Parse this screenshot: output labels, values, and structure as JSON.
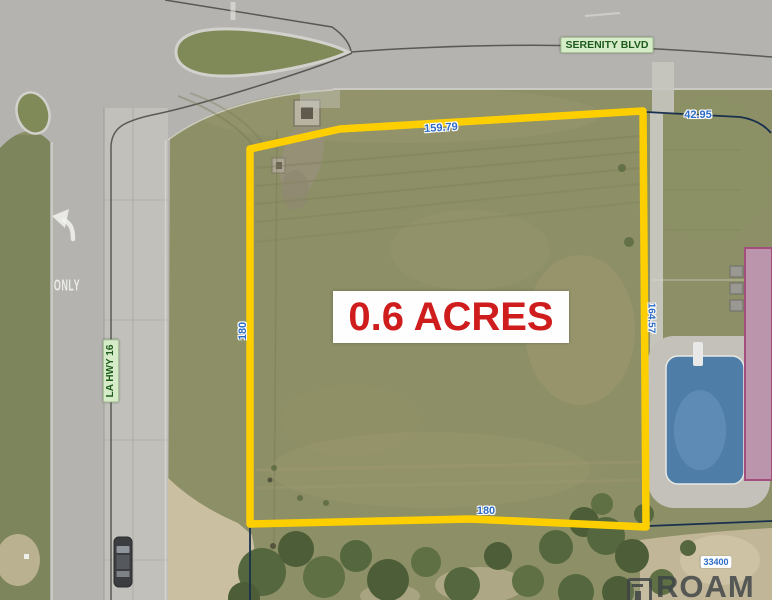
{
  "labels": {
    "acreage": "0.6 ACRES",
    "serenity_blvd": "SERENITY BLVD",
    "la_hwy": "LA HWY 16",
    "only_marking": "ONLY",
    "dim_top": "159.79",
    "dim_ne": "42.95",
    "dim_left": "180",
    "dim_right": "164.57",
    "dim_bottom": "180",
    "parcel_number": "33400",
    "watermark_brand": "ROAM"
  },
  "colors": {
    "boundary_yellow": "#fecf00",
    "dimension_blue": "#2d6cc6",
    "acreage_red": "#cf1d1d",
    "road_label_green": "#1d5b1d",
    "pool_blue": "#4e7da8",
    "building_pink": "#ba95ab"
  }
}
